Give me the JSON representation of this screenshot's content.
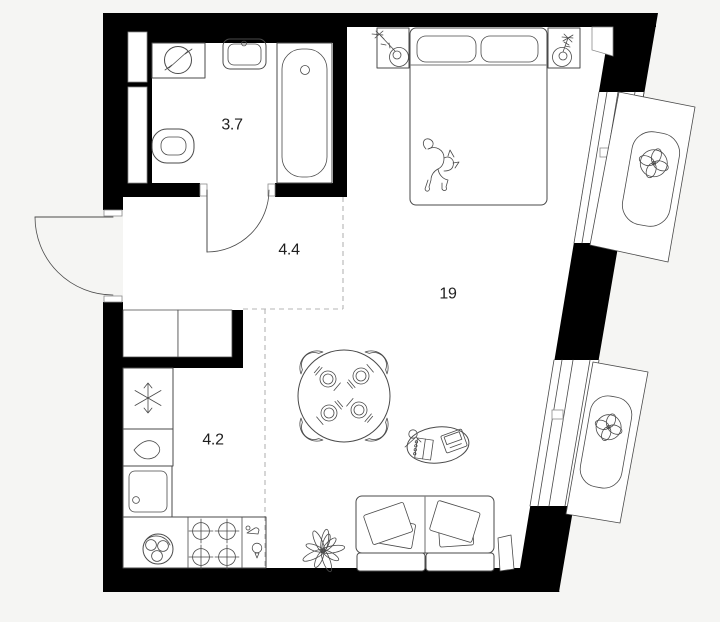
{
  "document": {
    "title": "Studio apartment floor plan"
  },
  "colors": {
    "wall": "#000000",
    "background": "#f5f5f3",
    "floor": "#ffffff",
    "line": "#4a4a4a",
    "dashed_zone_line": "#b5b5b5",
    "label_text": "#1f1f1f"
  },
  "rooms": [
    {
      "name": "bathroom",
      "area_label": "3.7"
    },
    {
      "name": "hallway",
      "area_label": "4.4"
    },
    {
      "name": "living-room",
      "area_label": "19"
    },
    {
      "name": "kitchen",
      "area_label": "4.2"
    }
  ],
  "icons": [
    "washing-machine-icon",
    "bath-sink-icon",
    "toilet-icon",
    "bathtub-icon",
    "door-swing-icon",
    "wardrobe-icon",
    "fridge-snowflake-icon",
    "water-drop-icon",
    "kitchen-sink-icon",
    "pot-icon",
    "stove-burners-icon",
    "tap-icon",
    "bulb-icon",
    "dining-table-icon",
    "chair-icon",
    "place-setting-icon",
    "bed-icon",
    "pillow-icon",
    "cat-icon",
    "nightstand-icon",
    "table-lamp-icon",
    "flower-icon",
    "coffee-table-icon",
    "laptop-icon",
    "notebook-icon",
    "magnifier-icon",
    "sofa-icon",
    "cushion-icon",
    "plant-icon",
    "window-icon",
    "fan-icon",
    "ac-basket-icon"
  ]
}
